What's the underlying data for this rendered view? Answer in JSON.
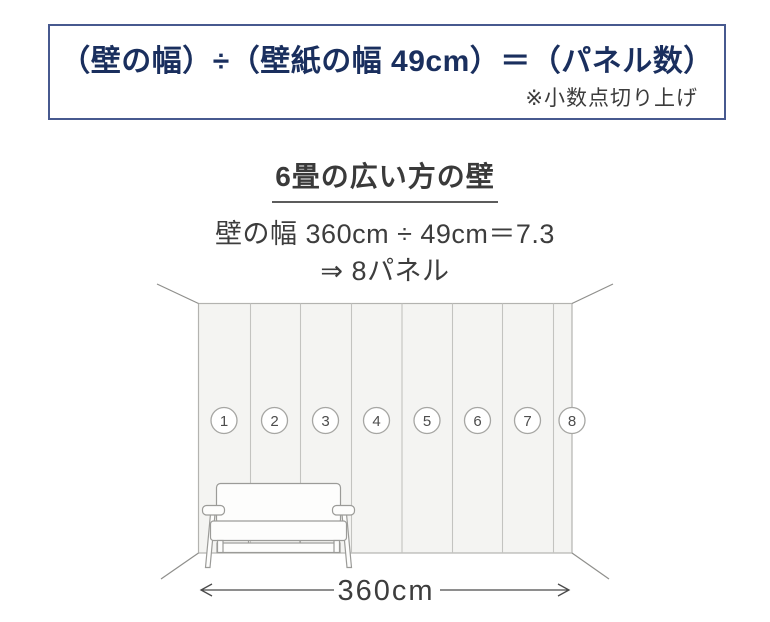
{
  "formula_box": {
    "formula": "（壁の幅）÷（壁紙の幅 49cm）＝（パネル数）",
    "note": "※小数点切り上げ"
  },
  "example": {
    "heading": "6畳の広い方の壁",
    "calculation": "壁の幅 360cm ÷ 49cm＝7.3",
    "result": "⇒ 8パネル"
  },
  "diagram": {
    "panel_count": 8,
    "panel_numbers": [
      "1",
      "2",
      "3",
      "4",
      "5",
      "6",
      "7",
      "8"
    ],
    "width_label": "360cm"
  },
  "colors": {
    "accent_navy": "#1a2f5e",
    "box_border": "#47598f",
    "body_text": "#3d3d3d",
    "wall_fill": "#f4f4f2",
    "wall_line": "#b3b3b0",
    "sketch_line": "#9b9b98"
  }
}
